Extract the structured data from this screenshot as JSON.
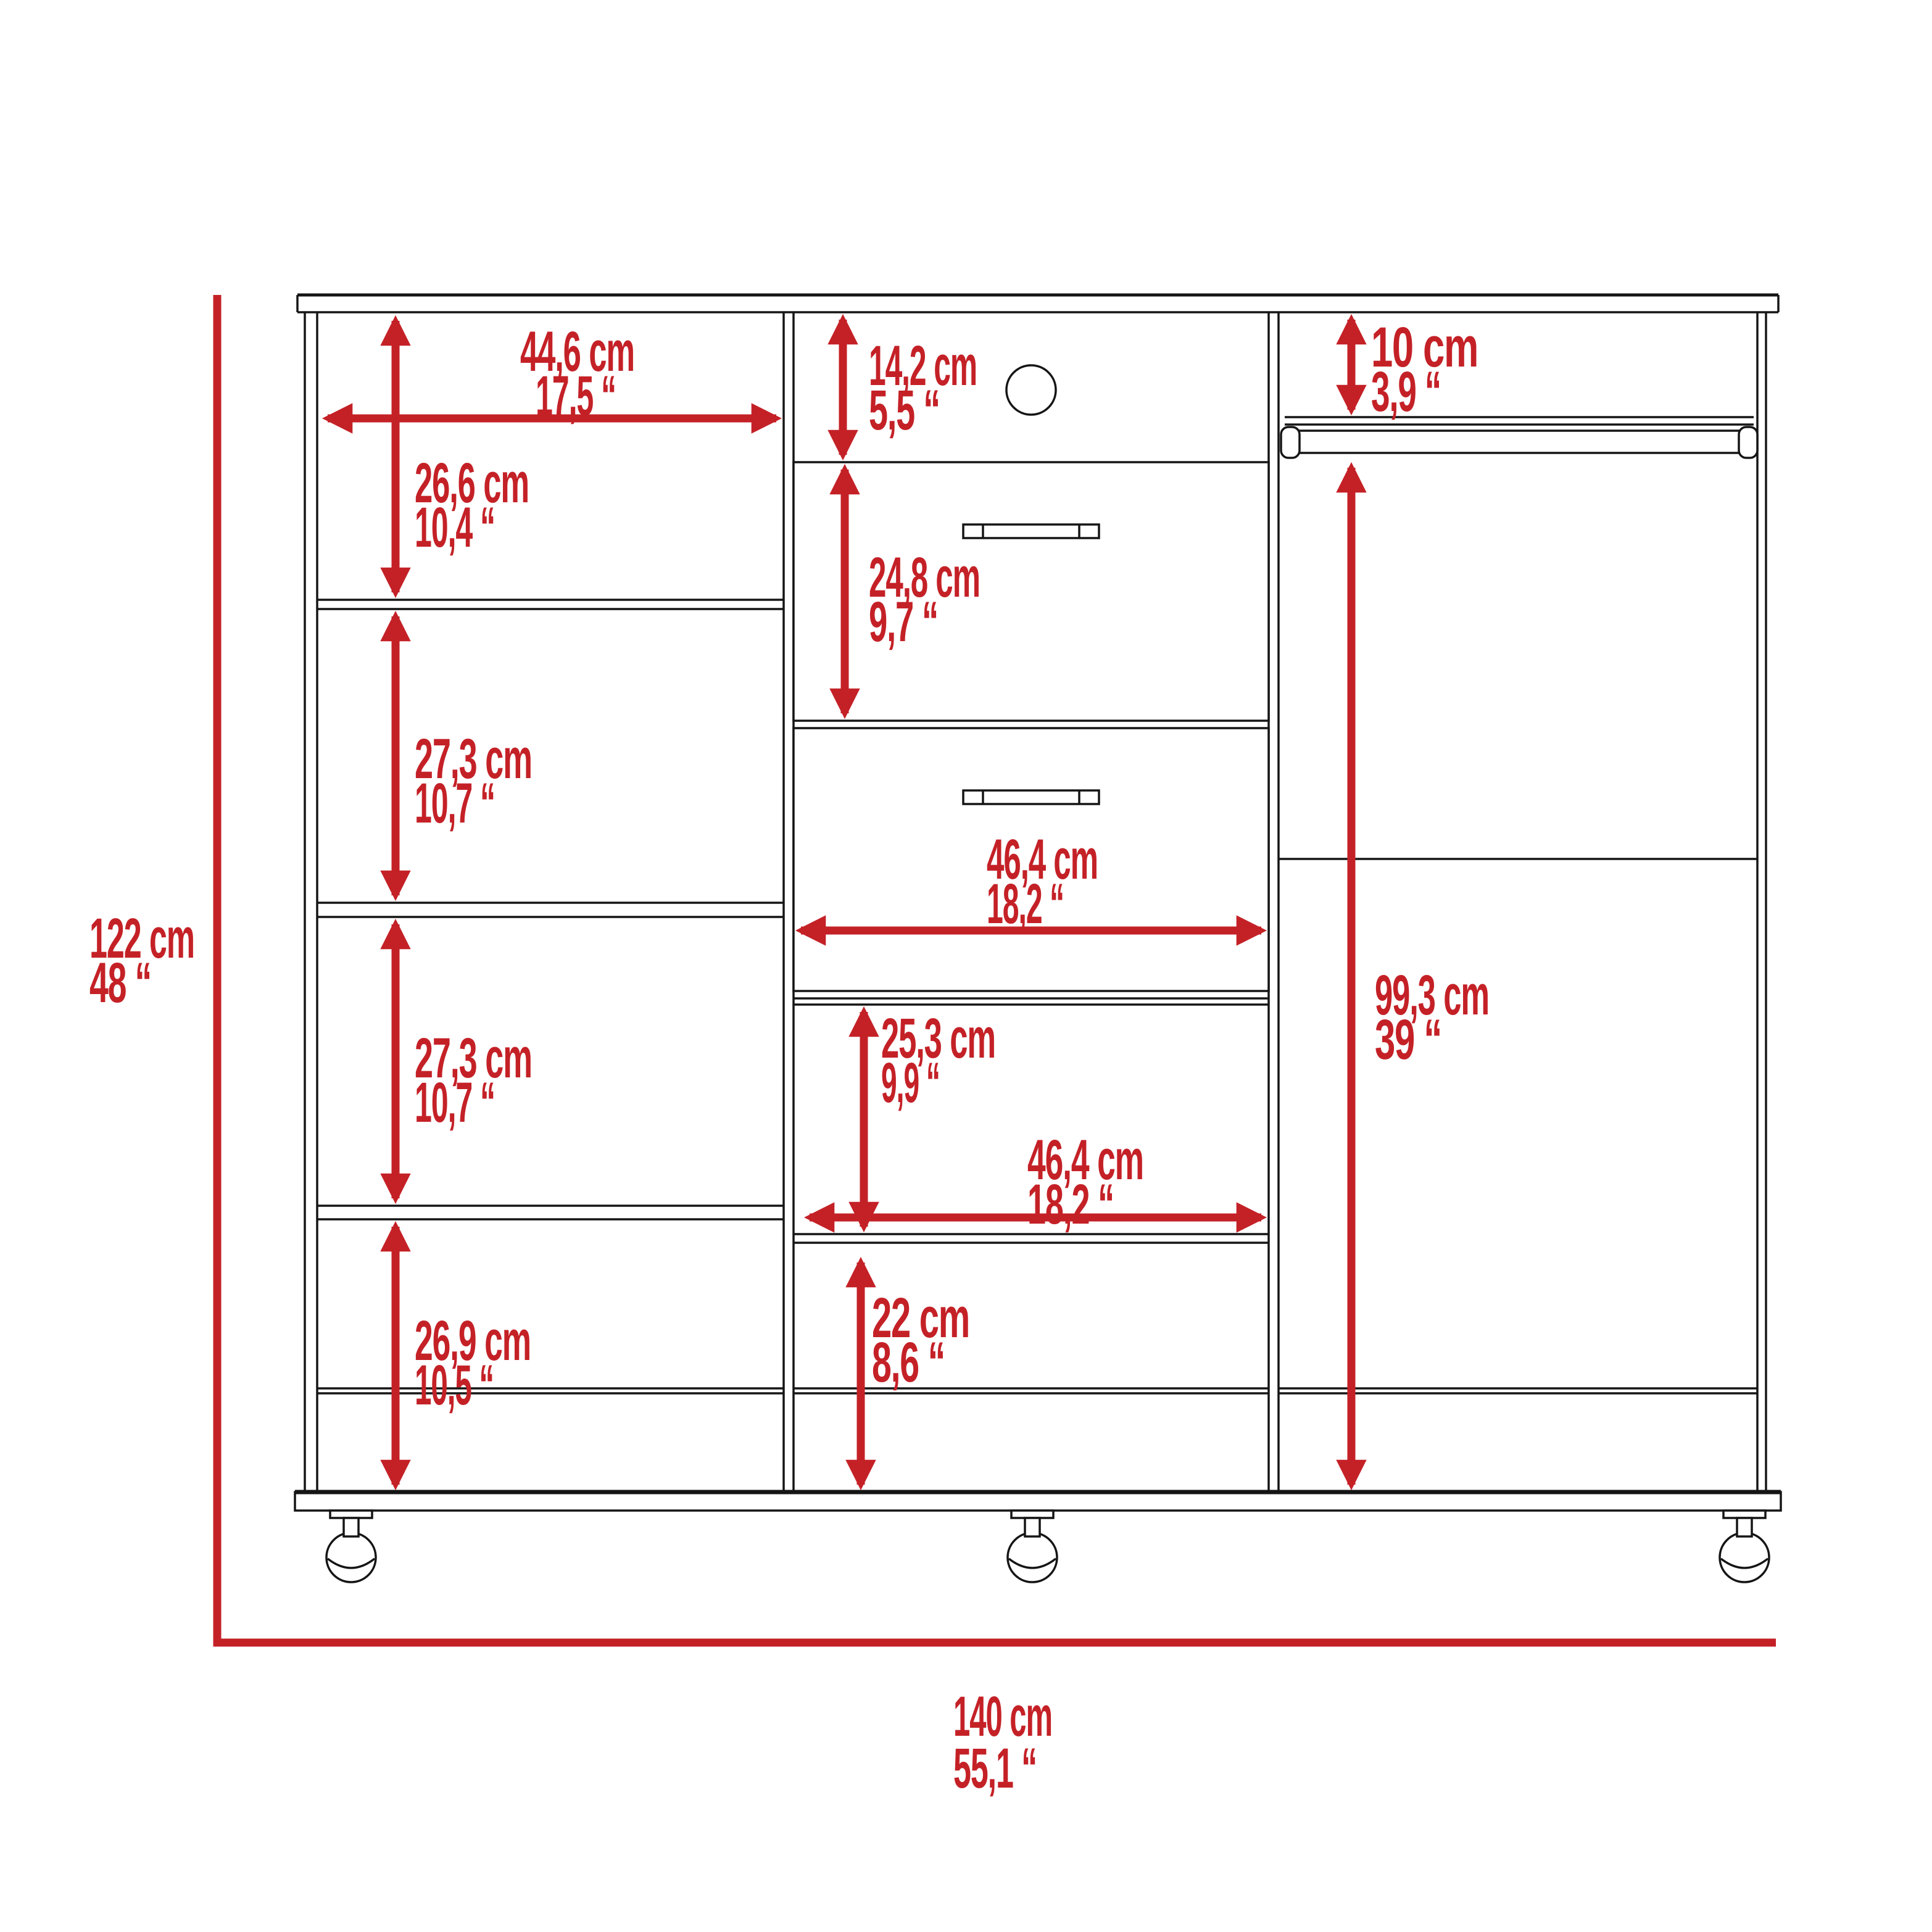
{
  "diagram": {
    "type": "furniture_dimension_drawing",
    "subject": "three-section dresser closet with shelves, two drawers and hanging rod on casters",
    "units": [
      "cm",
      "inch"
    ],
    "colors": {
      "dimension_annotations": "#c42127",
      "outline": "#151515",
      "background": "#ffffff"
    },
    "features": {
      "drawers": 2,
      "casters": 3,
      "left_compartments": 4,
      "hanging_rod": true,
      "grommet_hole": true
    }
  },
  "overall": {
    "height": {
      "cm": "122 cm",
      "in": "48 “",
      "cm_value": 122,
      "in_value": 48
    },
    "width": {
      "cm": "140 cm",
      "in": "55,1 “",
      "cm_value": 140,
      "in_value": 55.1
    }
  },
  "left_section": {
    "width": {
      "cm": "44,6 cm",
      "in": "17,5 “",
      "cm_value": 44.6,
      "in_value": 17.5
    },
    "compartments": [
      {
        "name": "compartment-1",
        "cm": "26,6 cm",
        "in": "10,4 “",
        "cm_value": 26.6,
        "in_value": 10.4
      },
      {
        "name": "compartment-2",
        "cm": "27,3 cm",
        "in": "10,7 “",
        "cm_value": 27.3,
        "in_value": 10.7
      },
      {
        "name": "compartment-3",
        "cm": "27,3 cm",
        "in": "10,7 “",
        "cm_value": 27.3,
        "in_value": 10.7
      },
      {
        "name": "compartment-4",
        "cm": "26,9 cm",
        "in": "10,5 “",
        "cm_value": 26.9,
        "in_value": 10.5
      }
    ]
  },
  "middle_section": {
    "top_opening": {
      "cm": "14,2 cm",
      "in": "5,5 “",
      "cm_value": 14.2,
      "in_value": 5.5
    },
    "drawer_height": {
      "cm": "24,8 cm",
      "in": "9,7 “",
      "cm_value": 24.8,
      "in_value": 9.7
    },
    "drawer_width": {
      "cm": "46,4 cm",
      "in": "18,2 “",
      "cm_value": 46.4,
      "in_value": 18.2
    },
    "open_shelf_height": {
      "cm": "25,3 cm",
      "in": "9,9 “",
      "cm_value": 25.3,
      "in_value": 9.9
    },
    "open_shelf_width": {
      "cm": "46,4 cm",
      "in": "18,2 “",
      "cm_value": 46.4,
      "in_value": 18.2
    },
    "bottom_opening": {
      "cm": "22 cm",
      "in": "8,6 “",
      "cm_value": 22,
      "in_value": 8.6
    }
  },
  "right_section": {
    "rod_clearance": {
      "cm": "10 cm",
      "in": "3,9 “",
      "cm_value": 10,
      "in_value": 3.9
    },
    "hanging_height": {
      "cm": "99,3 cm",
      "in": "39 “",
      "cm_value": 99.3,
      "in_value": 39
    }
  }
}
